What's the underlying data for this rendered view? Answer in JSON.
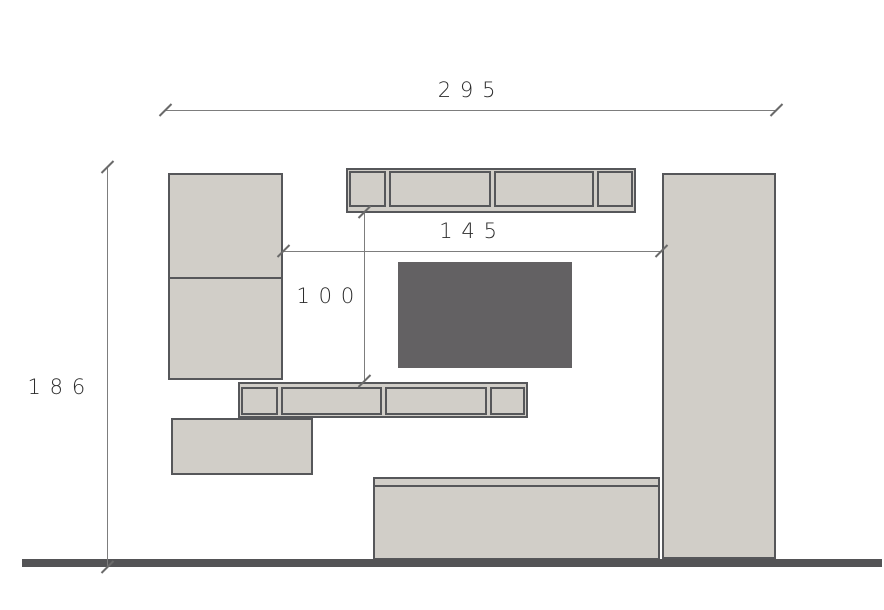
{
  "drawing": {
    "dimensions": {
      "overall_width": "295",
      "overall_height": "186",
      "niche_width": "145",
      "niche_height": "100"
    },
    "colors": {
      "background": "#ffffff",
      "unit_fill": "#d1cec8",
      "unit_outline": "#56575a",
      "tv_fill": "#636163",
      "floor": "#545456",
      "dimension_line": "#7d7d7d",
      "dimension_text": "#2d2d2d"
    }
  }
}
